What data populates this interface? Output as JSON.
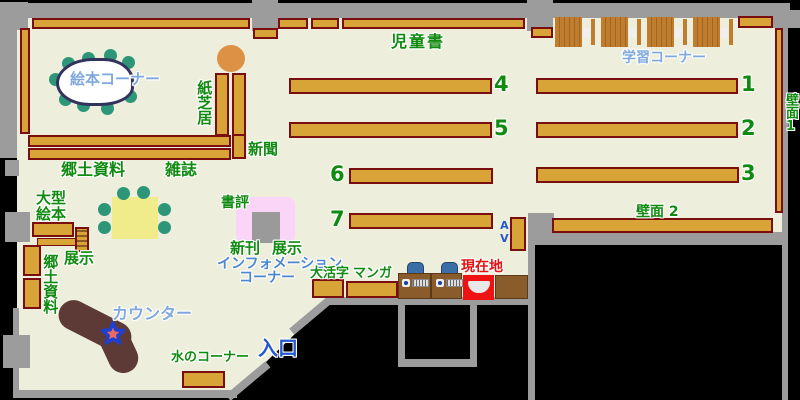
{
  "map_title": "library-floor-map",
  "areas": {
    "picture_book_corner": "絵本コーナー",
    "kamishibai": "紙芝居",
    "newspaper": "新聞",
    "children_books": "児童書",
    "study_corner": "学習コーナー",
    "wall_face_1": "壁面1",
    "wall_face_2": "壁面 2",
    "local_materials_upper": "郷土資料",
    "magazines": "雑誌",
    "large_picture_books": "大型\n絵本",
    "display_left": "展示",
    "local_materials_left": "郷土資料",
    "book_review": "書評",
    "new_arrivals": "新刊",
    "display_center": "展示",
    "information_line1": "インフォメーション",
    "information_line2": "コーナー",
    "large_print": "大活字",
    "manga": "マンガ",
    "current_location": "現在地",
    "counter": "カウンター",
    "water_corner": "水のコーナー",
    "entrance": "入口",
    "av": "AV"
  },
  "shelf_numbers": {
    "n1": "1",
    "n2": "2",
    "n3": "3",
    "n4": "4",
    "n5": "5",
    "n6": "6",
    "n7": "7"
  },
  "colors": {
    "floor": "#EDEFDC",
    "wall_gray": "#9C9C9C",
    "shelf_tan": "#D9A437",
    "shelf_border": "#7A0D0D",
    "counter_brown": "#5D3A36",
    "table_yellow": "#F1EC8B",
    "stool_teal": "#2D9678",
    "round_table_orange": "#DD9145",
    "review_pink": "#FAD5F8",
    "marker_red": "#EE1212",
    "chair_blue": "#3A6EA5",
    "label_green": "#108A10",
    "label_light_blue": "#7FA9DE",
    "label_blue": "#2558CE"
  }
}
